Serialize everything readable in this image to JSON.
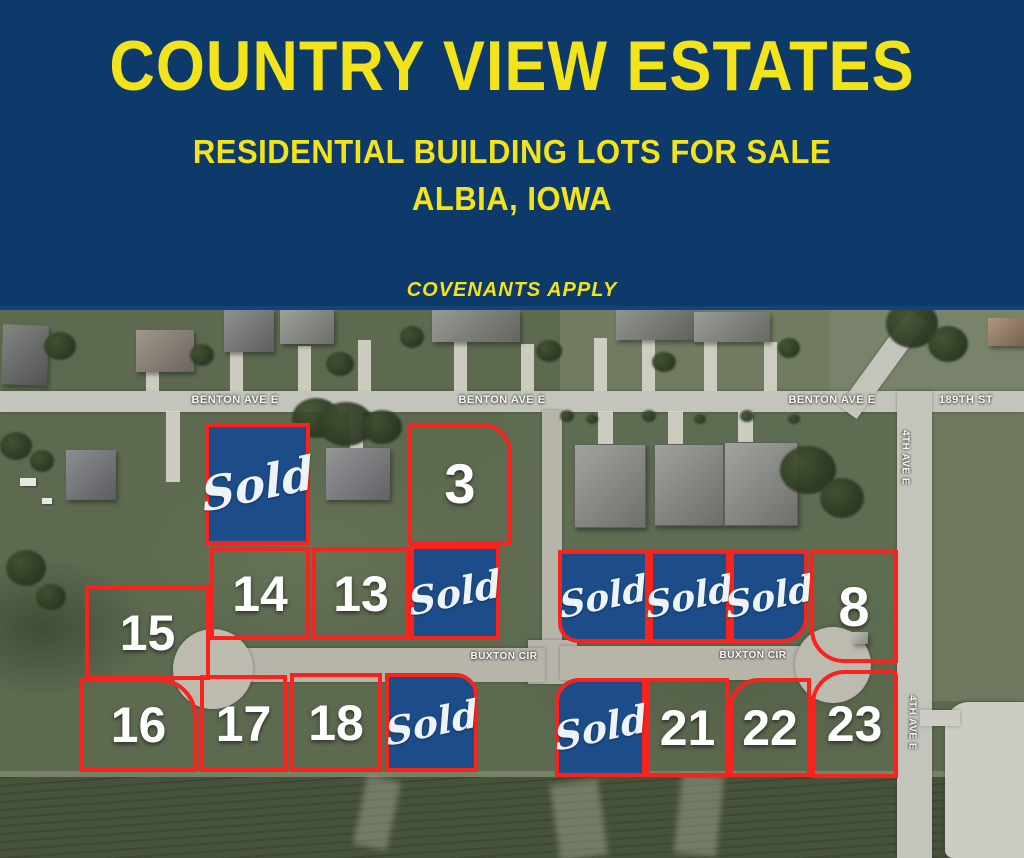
{
  "header": {
    "title": "COUNTRY VIEW ESTATES",
    "subtitle": "RESIDENTIAL BUILDING LOTS FOR SALE",
    "location": "ALBIA, IOWA",
    "note": "COVENANTS APPLY"
  },
  "colors": {
    "header_bg": "#0d396b",
    "header_text": "#f2e31a",
    "lot_outline_red": "#f8231d",
    "sold_fill_blue": "#1c4c89",
    "grass_green": "#5d6a50",
    "road_gray": "#c3c5bc"
  },
  "map": {
    "street_labels": {
      "benton": [
        "BENTON AVE E",
        "BENTON AVE E",
        "BENTON AVE E"
      ],
      "street_189": "189TH ST",
      "ave_4th": [
        "4TH AVE E",
        "4TH AVE E"
      ],
      "buxton": [
        "BUXTON CIR",
        "BUXTON CIR"
      ]
    },
    "lots": [
      {
        "id": "sold-a",
        "label": "Sold",
        "sold": true
      },
      {
        "id": "3",
        "label": "3",
        "sold": false
      },
      {
        "id": "14",
        "label": "14",
        "sold": false
      },
      {
        "id": "13",
        "label": "13",
        "sold": false
      },
      {
        "id": "sold-b",
        "label": "Sold",
        "sold": true
      },
      {
        "id": "15",
        "label": "15",
        "sold": false
      },
      {
        "id": "sold-c",
        "label": "Sold",
        "sold": true
      },
      {
        "id": "sold-d",
        "label": "Sold",
        "sold": true
      },
      {
        "id": "sold-e",
        "label": "Sold",
        "sold": true
      },
      {
        "id": "8",
        "label": "8",
        "sold": false
      },
      {
        "id": "16",
        "label": "16",
        "sold": false
      },
      {
        "id": "17",
        "label": "17",
        "sold": false
      },
      {
        "id": "18",
        "label": "18",
        "sold": false
      },
      {
        "id": "sold-f",
        "label": "Sold",
        "sold": true
      },
      {
        "id": "sold-g",
        "label": "Sold",
        "sold": true
      },
      {
        "id": "21",
        "label": "21",
        "sold": false
      },
      {
        "id": "22",
        "label": "22",
        "sold": false
      },
      {
        "id": "23",
        "label": "23",
        "sold": false
      }
    ]
  }
}
